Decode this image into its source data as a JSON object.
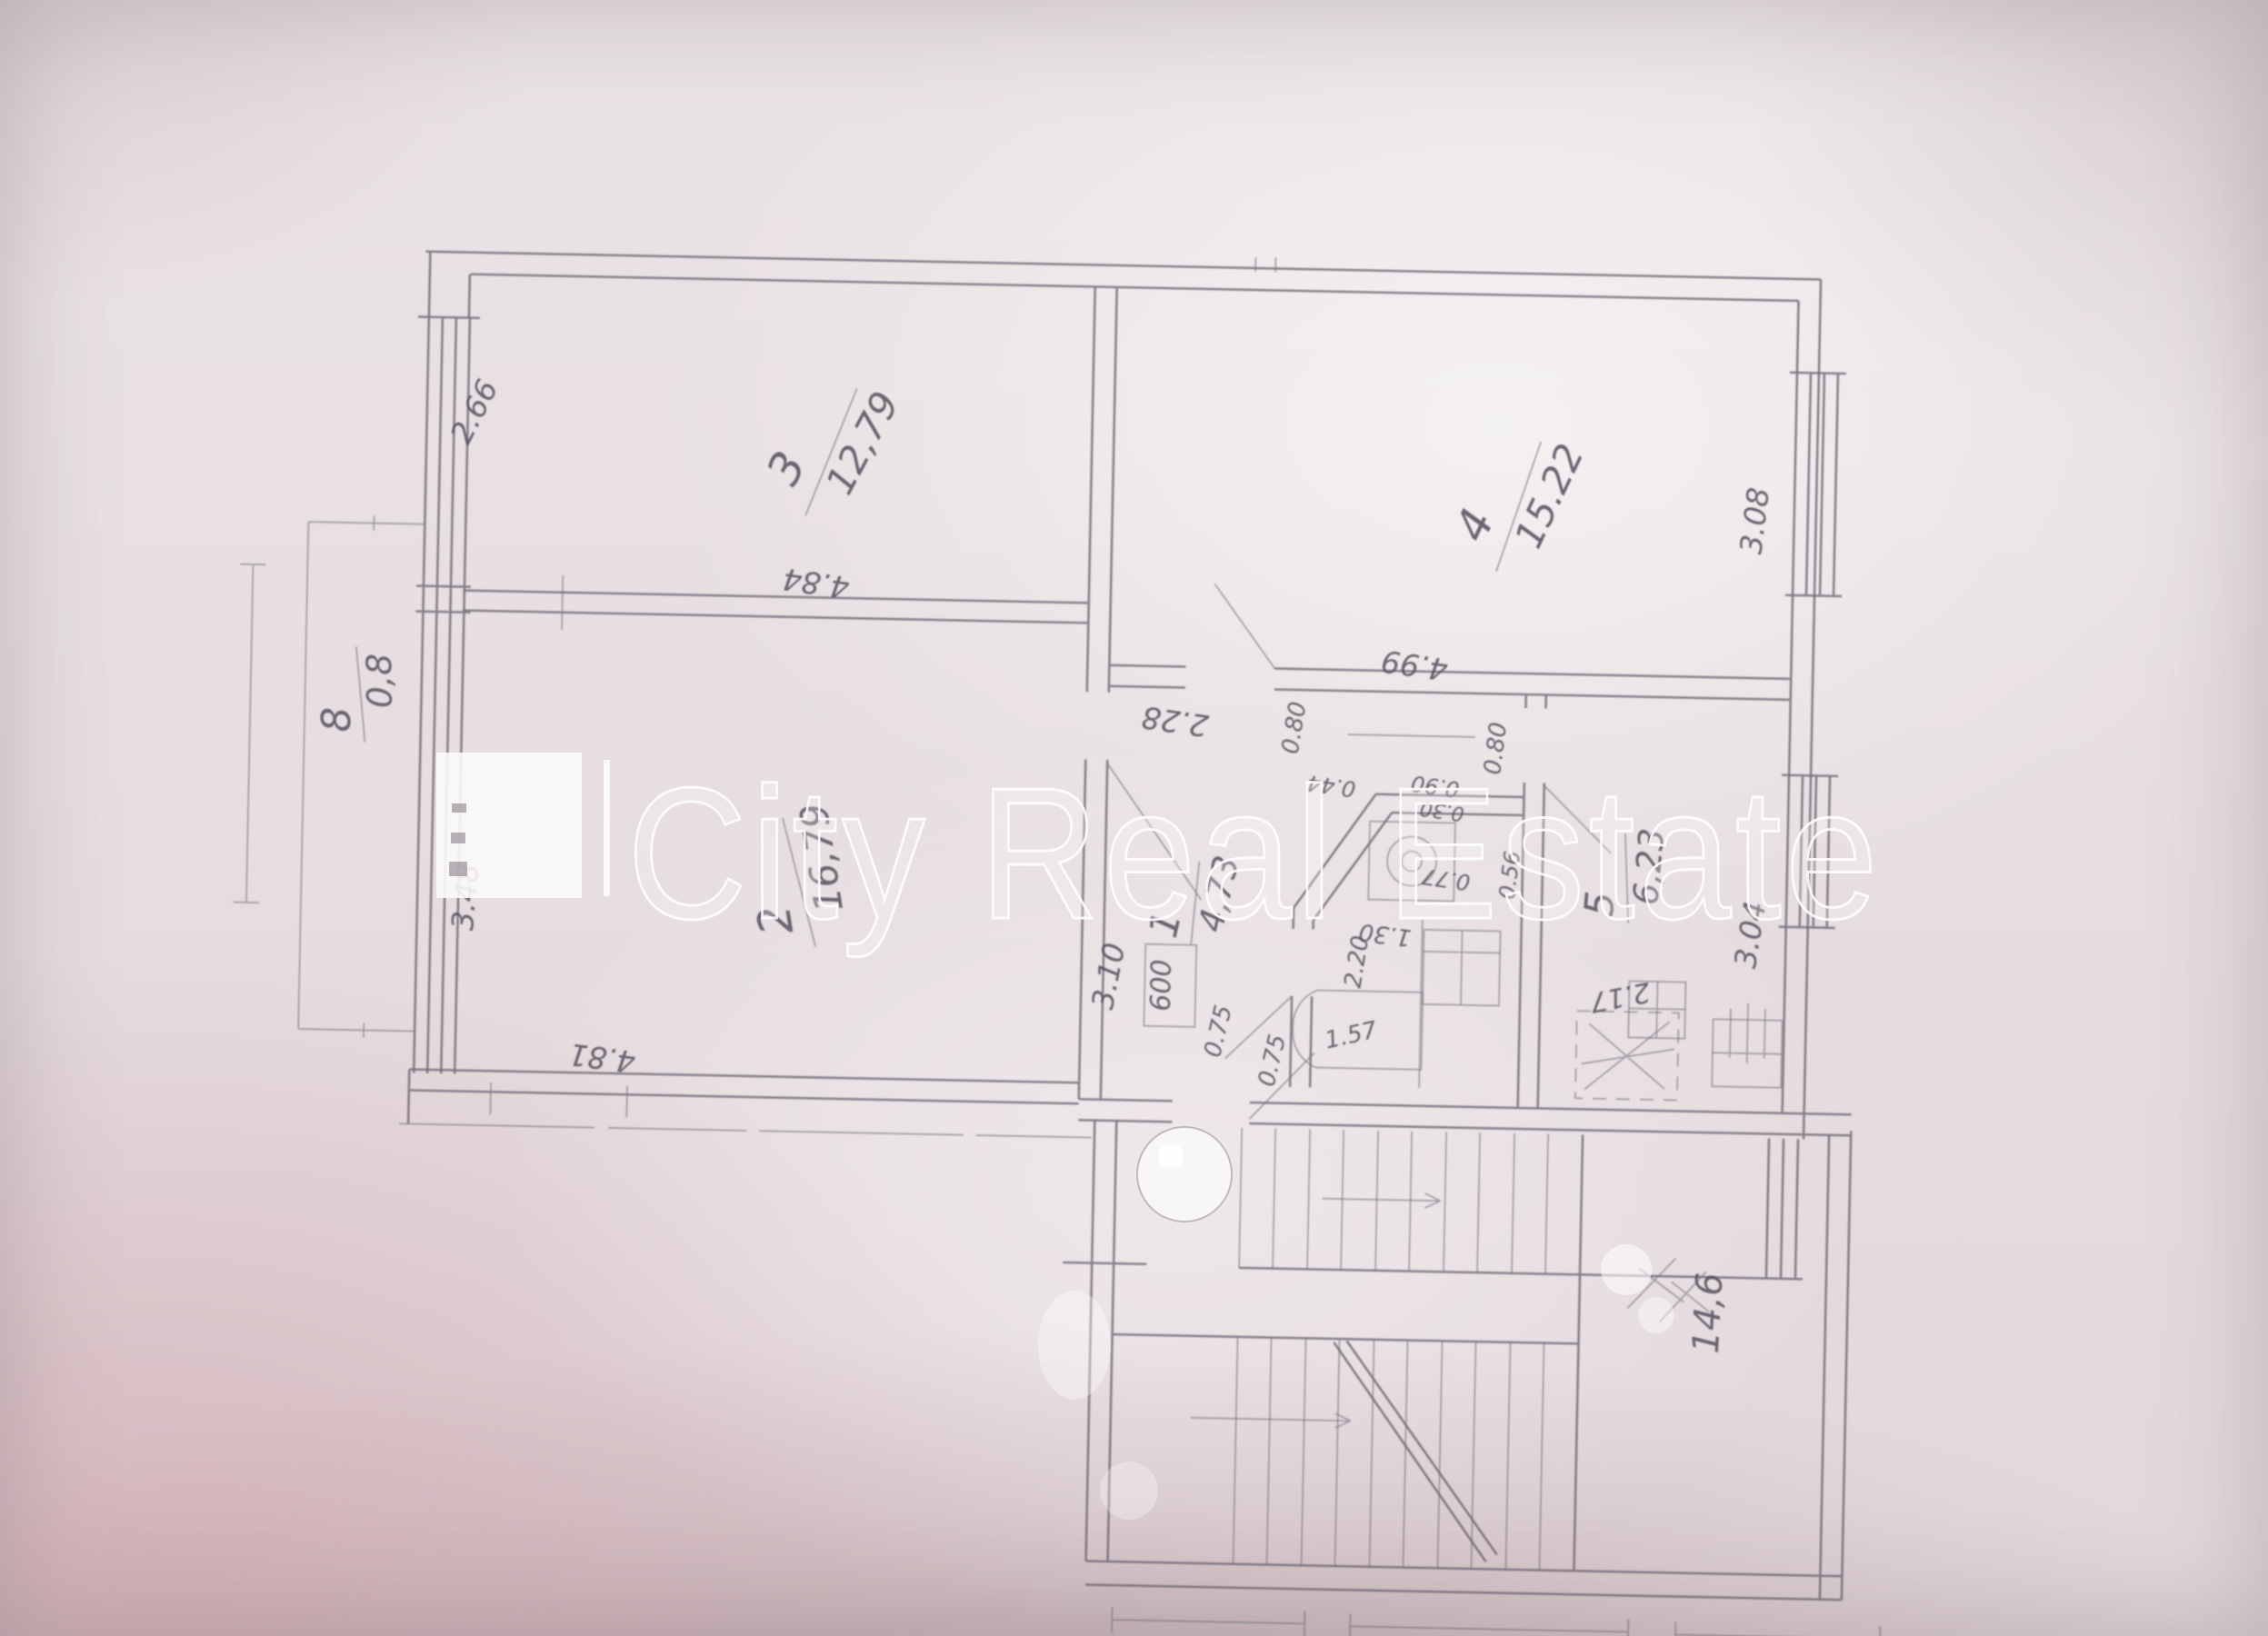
{
  "watermark": {
    "text": "City Real Estate",
    "logo": "white-square-logo",
    "separator_bar": "vertical-white-bar"
  },
  "plan": {
    "rooms": [
      {
        "number": "3",
        "area": "12,79"
      },
      {
        "number": "4",
        "area": "15.22"
      },
      {
        "number": "2",
        "area": "16,79"
      },
      {
        "number": "8",
        "area": "0,8"
      },
      {
        "number": "1",
        "area": "4,73"
      },
      {
        "number": "5",
        "area": "6,23"
      }
    ],
    "stair_area": "14,6",
    "dimensions": {
      "room3_width": "4.84",
      "room3_depth": "2.66",
      "room4_width": "4.99",
      "room4_depth": "3.08",
      "room2_width": "4.81",
      "room2_depth": "3.48",
      "kitchen_width": "2.17",
      "kitchen_depth": "3.04",
      "hall_length": "3.10",
      "corridor_width": "2.28",
      "bath_length": "2.20",
      "tub_length": "1.57",
      "wc_width": "1.30",
      "closet_depth": "600",
      "door_widths": [
        "0.75",
        "0.75",
        "0.80",
        "0.80",
        "0.44",
        "0.90",
        "0.30",
        "0.56",
        "0.77"
      ]
    }
  }
}
